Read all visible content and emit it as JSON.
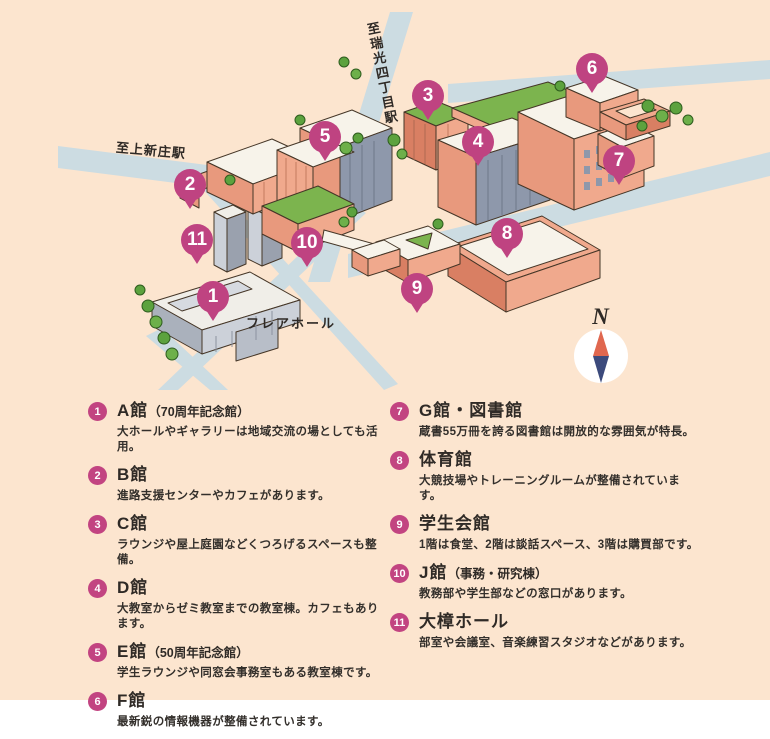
{
  "colors": {
    "background": "#fce5cf",
    "road": "#ccdce2",
    "marker_pink": "#bf4381",
    "building_salmon": "#f0a98d",
    "building_salmon_dark": "#d97f63",
    "roof_green": "#7cb44e",
    "roof_white": "#f7f3ea",
    "tree_green": "#5ca23e",
    "compass_north": "#e0674f",
    "compass_south": "#3c4a7c"
  },
  "map": {
    "station_label_top": "至瑞光四丁目駅",
    "station_label_left": "至上新庄駅",
    "flair_hall_label": "フレアホール",
    "compass_label": "N",
    "markers": [
      {
        "num": "1",
        "x": 213,
        "y": 297
      },
      {
        "num": "2",
        "x": 190,
        "y": 185
      },
      {
        "num": "3",
        "x": 428,
        "y": 96
      },
      {
        "num": "4",
        "x": 478,
        "y": 142
      },
      {
        "num": "5",
        "x": 325,
        "y": 137
      },
      {
        "num": "6",
        "x": 592,
        "y": 69
      },
      {
        "num": "7",
        "x": 619,
        "y": 161
      },
      {
        "num": "8",
        "x": 507,
        "y": 234
      },
      {
        "num": "9",
        "x": 417,
        "y": 289
      },
      {
        "num": "10",
        "x": 307,
        "y": 243
      },
      {
        "num": "11",
        "x": 197,
        "y": 240
      }
    ]
  },
  "legend": {
    "columns": [
      {
        "items": [
          {
            "num": "1",
            "title": "A館",
            "paren": "（70周年記念館）",
            "desc": "大ホールやギャラリーは地域交流の場としても活用。"
          },
          {
            "num": "2",
            "title": "B館",
            "paren": "",
            "desc": "進路支援センターやカフェがあります。"
          },
          {
            "num": "3",
            "title": "C館",
            "paren": "",
            "desc": "ラウンジや屋上庭園などくつろげるスペースも整備。"
          },
          {
            "num": "4",
            "title": "D館",
            "paren": "",
            "desc": "大教室からゼミ教室までの教室棟。カフェもあります。"
          },
          {
            "num": "5",
            "title": "E館",
            "paren": "（50周年記念館）",
            "desc": "学生ラウンジや同窓会事務室もある教室棟です。"
          },
          {
            "num": "6",
            "title": "F館",
            "paren": "",
            "desc": "最新鋭の情報機器が整備されています。"
          }
        ]
      },
      {
        "items": [
          {
            "num": "7",
            "title": "G館・図書館",
            "paren": "",
            "desc": "蔵書55万冊を誇る図書館は開放的な雰囲気が特長。"
          },
          {
            "num": "8",
            "title": "体育館",
            "paren": "",
            "desc": "大競技場やトレーニングルームが整備されています。"
          },
          {
            "num": "9",
            "title": "学生会館",
            "paren": "",
            "desc": "1階は食堂、2階は談話スペース、3階は購買部です。"
          },
          {
            "num": "10",
            "title": "J館",
            "paren": "（事務・研究棟）",
            "desc": "教務部や学生部などの窓口があります。"
          },
          {
            "num": "11",
            "title": "大樟ホール",
            "paren": "",
            "desc": "部室や会議室、音楽練習スタジオなどがあります。"
          }
        ]
      }
    ]
  }
}
